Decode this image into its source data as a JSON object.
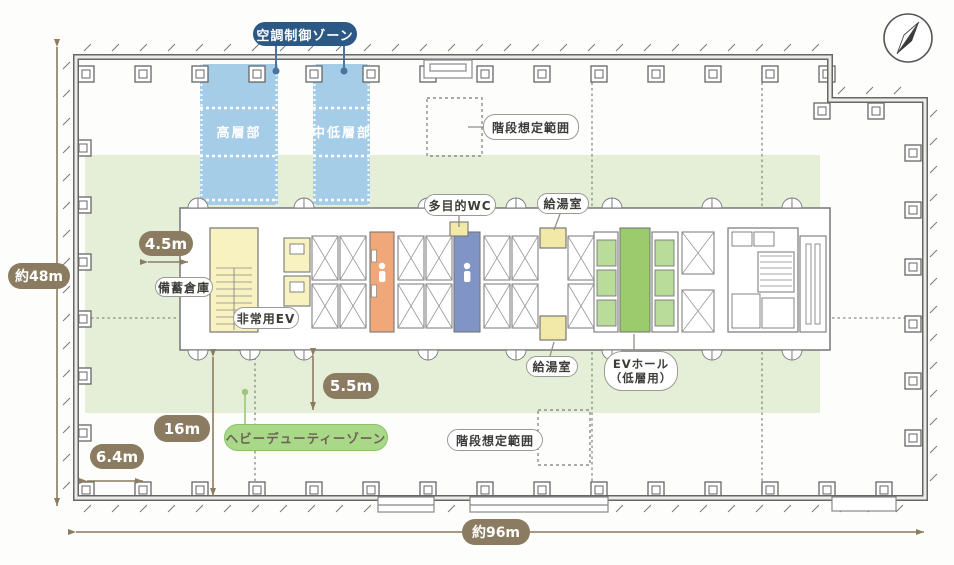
{
  "plan": {
    "zones": {
      "hvac_zone_label": "空調制御ゾーン",
      "high_rise_label": "高層部",
      "mid_low_rise_label": "中低層部",
      "heavy_duty_zone_label": "ヘビーデューティーゾーン"
    },
    "rooms": {
      "stair_range_top": "階段想定範囲",
      "stair_range_bottom": "階段想定範囲",
      "multipurpose_wc": "多目的WC",
      "kitchenette_top": "給湯室",
      "kitchenette_bottom": "給湯室",
      "ev_hall_line1": "EVホール",
      "ev_hall_line2": "（低層用）",
      "storage": "備蓄倉庫",
      "emergency_ev": "非常用EV"
    },
    "dimensions": {
      "d45": "4.5m",
      "d55": "5.5m",
      "d16": "16m",
      "d64": "6.4m",
      "width_total": "約96m",
      "depth_total": "約48m"
    },
    "icons": {
      "compass": "north-arrow-compass"
    },
    "colors": {
      "hvac_band_blue": "#a6cde8",
      "hvac_label_bg": "#2b5884",
      "flex_zone_green": "#e5efd8",
      "heavy_duty_pill_green": "#a9d888",
      "ev_hall_green": "#9bcb6d",
      "ev_car_green": "#b9dc9b",
      "wc_orange": "#f0a87a",
      "wc_blue": "#8095c5",
      "room_yellow": "#f7f2c0",
      "kitchenette_yellow": "#f2e9a8",
      "dimension_brown": "#8b7b60"
    }
  }
}
